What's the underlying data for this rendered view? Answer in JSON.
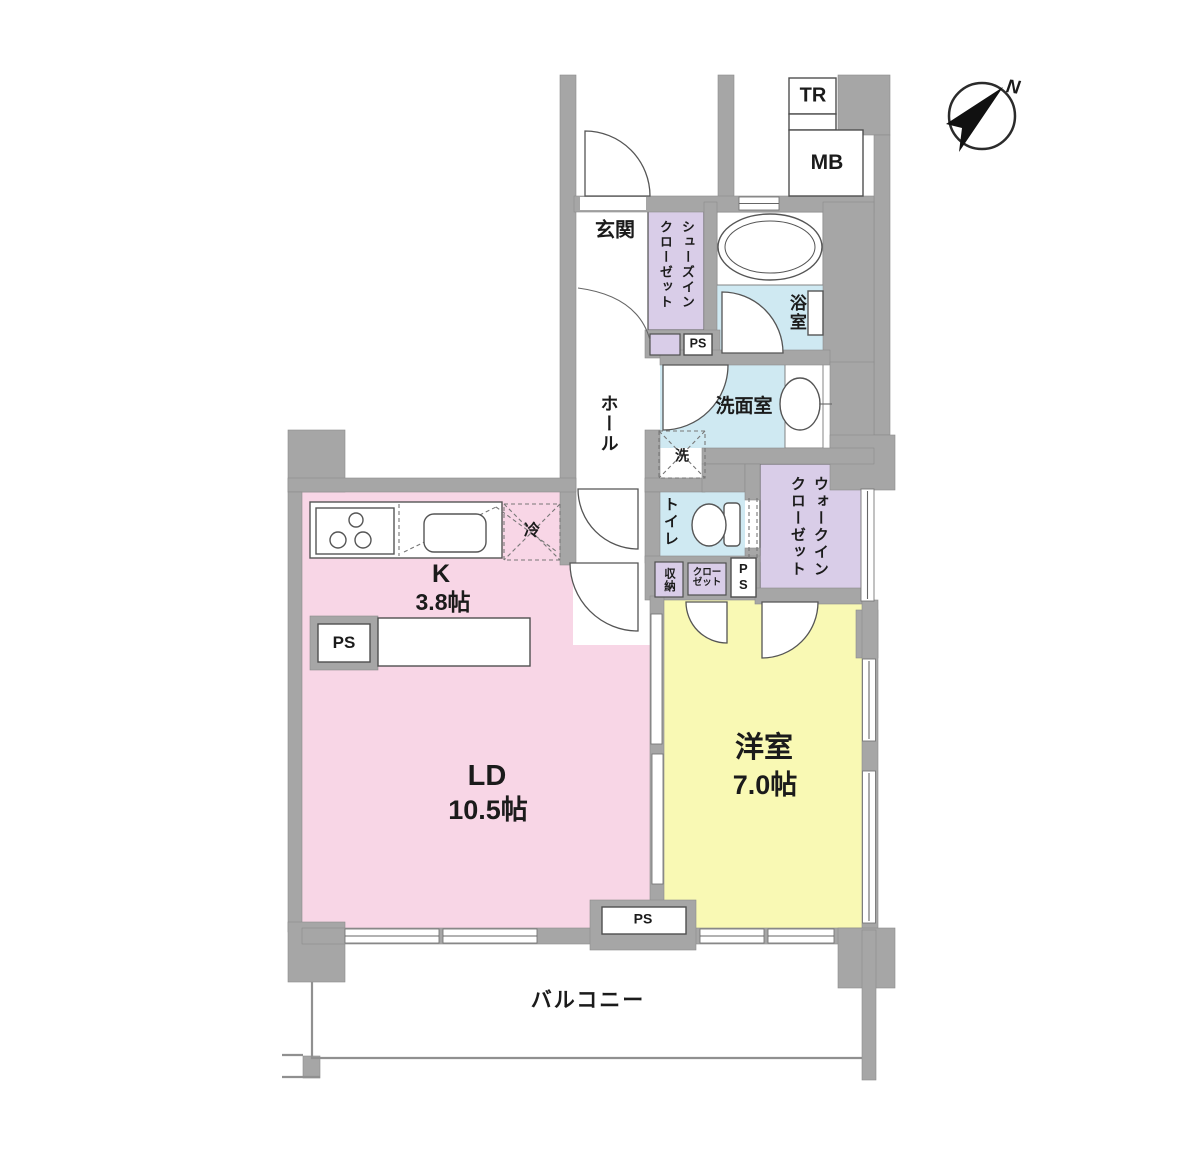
{
  "colors": {
    "wall": "#a6a6a6",
    "ldk": "#f8d6e6",
    "bedroom": "#f9f9b4",
    "wet": "#cfe9f2",
    "closet": "#d9cde8",
    "text": "#1b1b1b"
  },
  "compass": {
    "north": "N"
  },
  "labels": {
    "tr": "TR",
    "mb": "MB",
    "ps": "PS",
    "genkan": "玄関",
    "shoes_closet_line1": "シューズイン",
    "shoes_closet_line2": "クローゼット",
    "bathroom": "浴室",
    "washroom": "洗面室",
    "washing_machine": "洗",
    "hall": "ホール",
    "toilet": "トイレ",
    "wic_line1": "ウォークイン",
    "wic_line2": "クローゼット",
    "storage": "収納",
    "closet_line1": "クロー",
    "closet_line2": "ゼット",
    "refrigerator": "冷",
    "kitchen_name": "K",
    "kitchen_size": "3.8帖",
    "living_dining_name": "LD",
    "living_dining_size": "10.5帖",
    "western_room_name": "洋室",
    "western_room_size": "7.0帖",
    "balcony": "バルコニー"
  }
}
